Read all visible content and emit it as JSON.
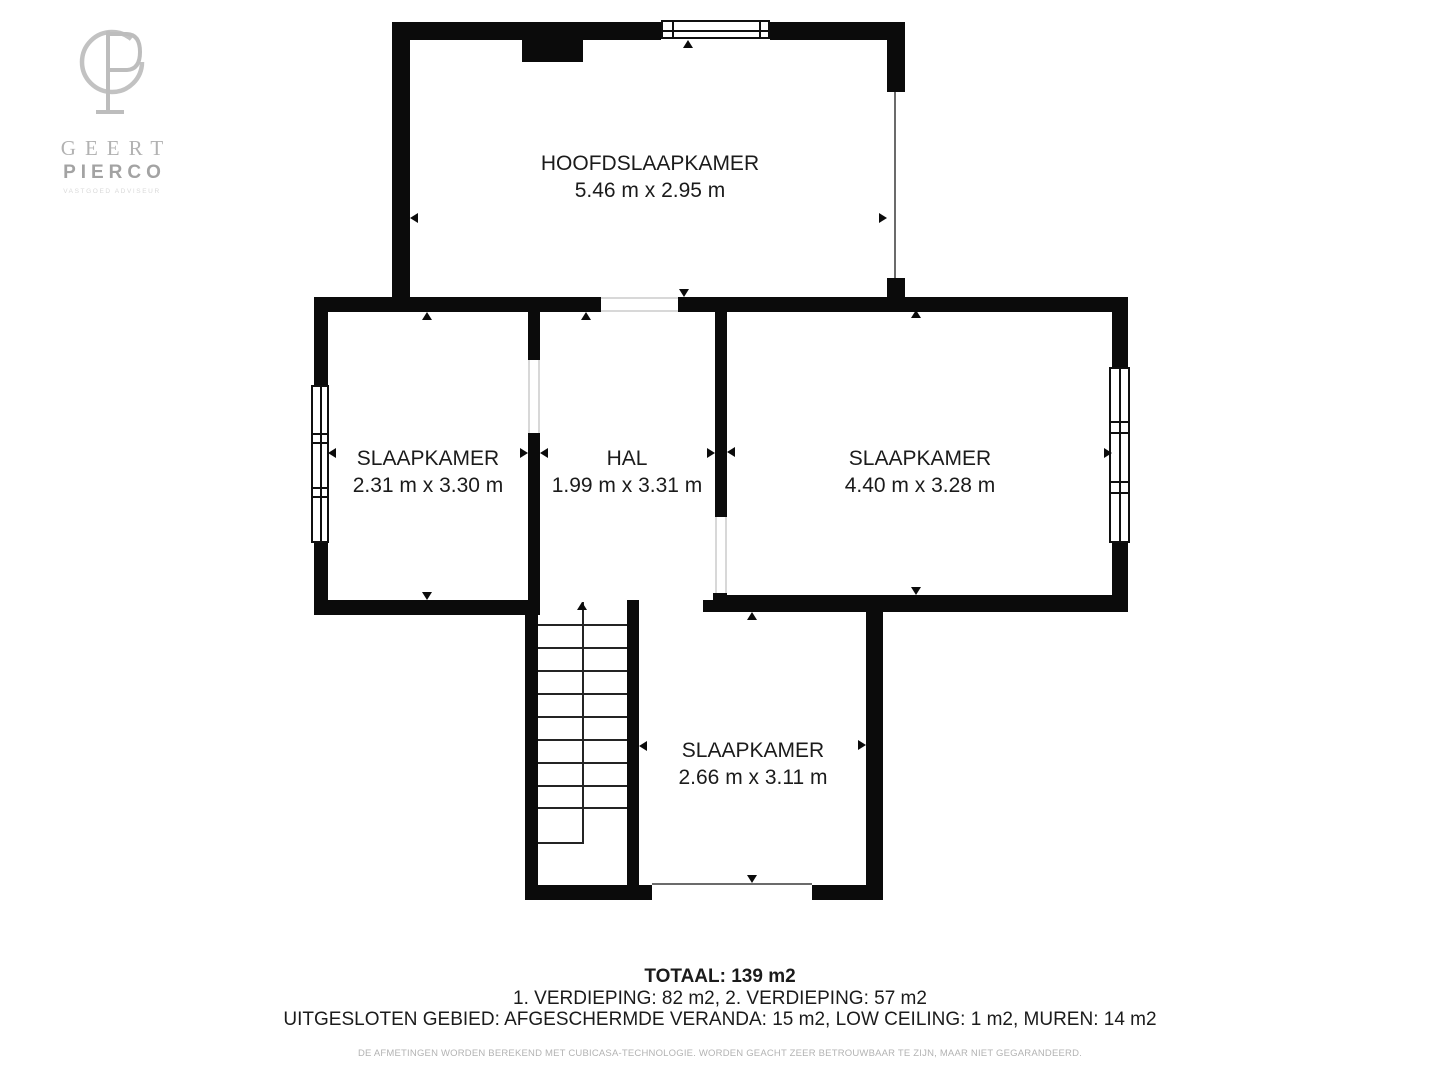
{
  "logo": {
    "line1": "GEERT",
    "line2": "PIERCO",
    "tagline": "VASTGOED ADVISEUR"
  },
  "rooms": [
    {
      "name": "HOOFDSLAAPKAMER",
      "dimensions": "5.46 m x 2.95 m"
    },
    {
      "name": "SLAAPKAMER",
      "dimensions": "2.31 m x 3.30 m"
    },
    {
      "name": "HAL",
      "dimensions": "1.99 m x 3.31 m"
    },
    {
      "name": "SLAAPKAMER",
      "dimensions": "4.40 m x 3.28 m"
    },
    {
      "name": "SLAAPKAMER",
      "dimensions": "2.66 m x 3.11 m"
    }
  ],
  "summary": {
    "total": "TOTAAL: 139 m2",
    "floors": "1. VERDIEPING: 82 m2, 2. VERDIEPING: 57 m2",
    "excluded": "UITGESLOTEN GEBIED: AFGESCHERMDE VERANDA: 15 m2, LOW CEILING: 1 m2, MUREN: 14 m2",
    "disclaimer": "DE AFMETINGEN WORDEN BEREKEND MET CUBICASA-TECHNOLOGIE. WORDEN GEACHT ZEER BETROUWBAAR TE ZIJN, MAAR NIET GEGARANDEERD."
  },
  "colors": {
    "wall": "#0b0b0b",
    "text": "#1b1b1b",
    "background": "#ffffff",
    "logo-gray": "#c2c2c2",
    "logo-text": "#b2b2b2",
    "logo-tagline": "#d9d9d9",
    "muted": "#b3b3b3"
  }
}
